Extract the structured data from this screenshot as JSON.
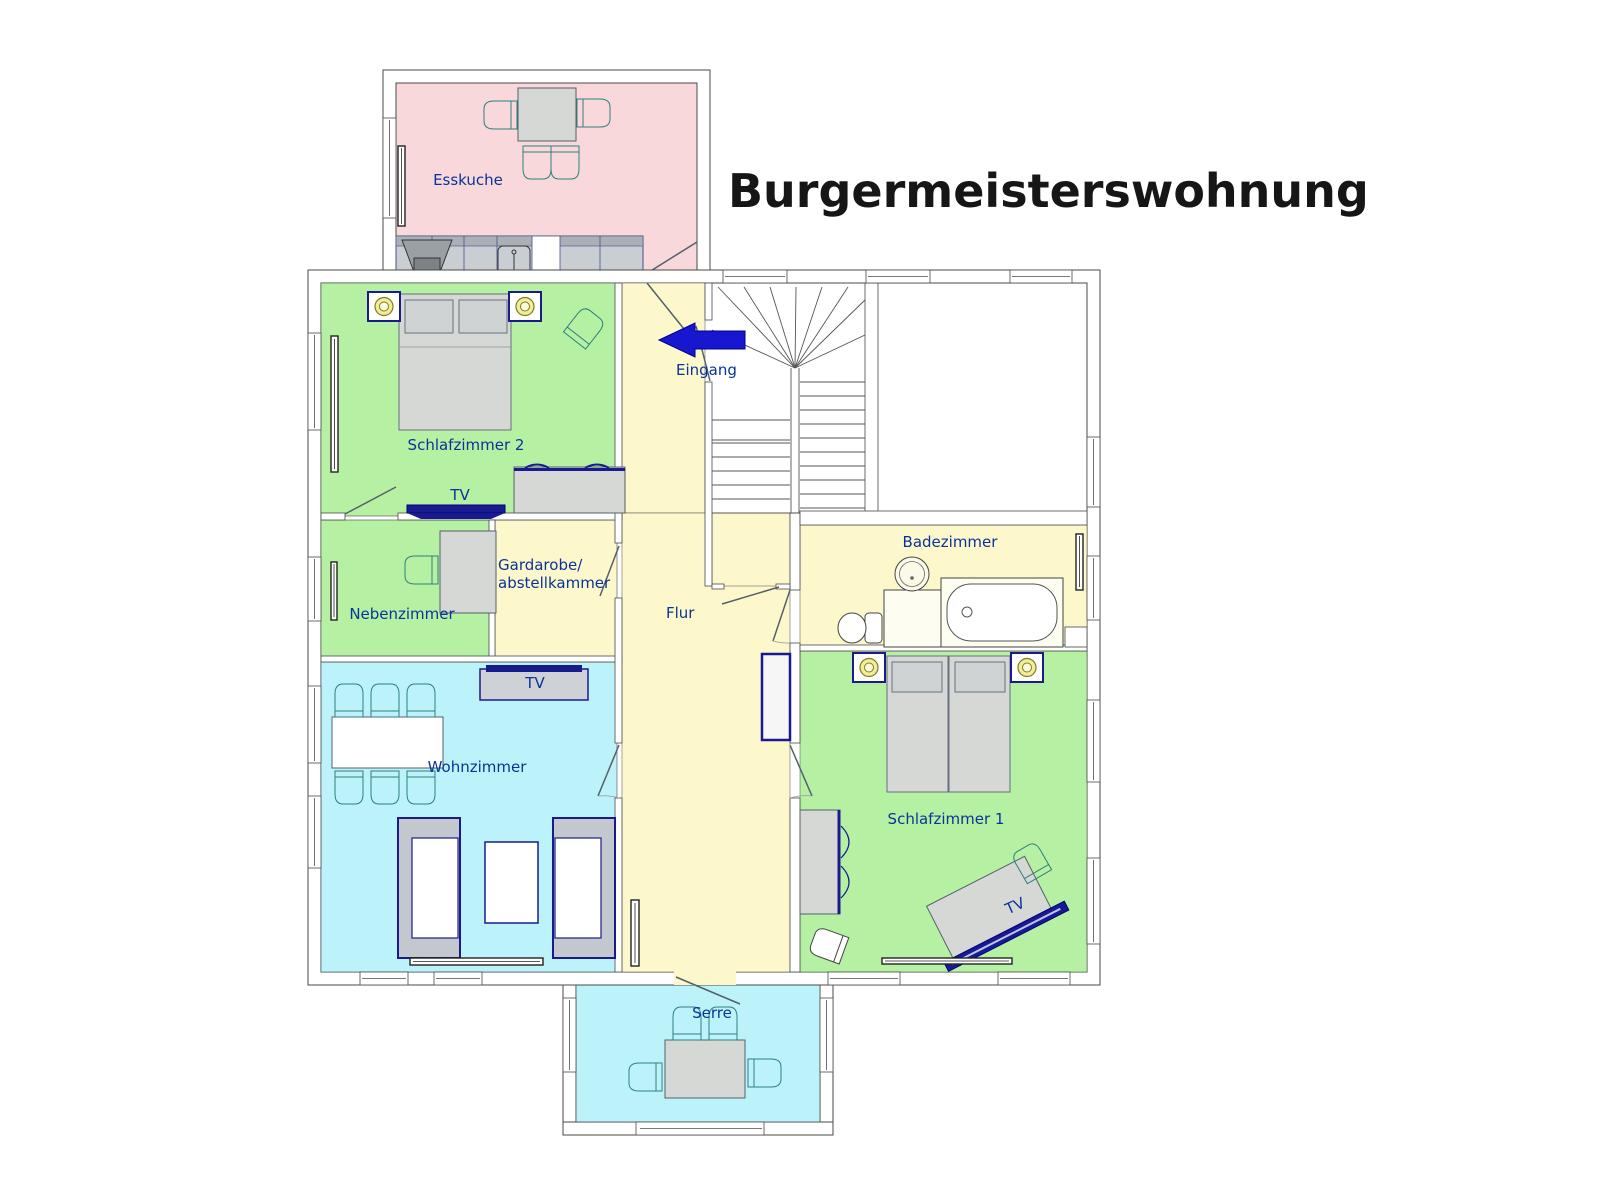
{
  "title": "Burgermeisterswohnung",
  "rooms": {
    "esskuche": {
      "label": "Esskuche",
      "color": "#f8d8db"
    },
    "schlafzimmer2": {
      "label": "Schlafzimmer 2",
      "color": "#b6f1a3"
    },
    "nebenzimmer": {
      "label": "Nebenzimmer",
      "color": "#b6f1a3"
    },
    "gardarobe": {
      "label_line1": "Gardarobe/",
      "label_line2": "abstellkammer",
      "color": "#fcf8cc"
    },
    "flur": {
      "label": "Flur",
      "color": "#fcf8cc"
    },
    "badezimmer": {
      "label": "Badezimmer",
      "color": "#fcf8cc"
    },
    "wohnzimmer": {
      "label": "Wohnzimmer",
      "color": "#bcf3fa"
    },
    "schlafzimmer1": {
      "label": "Schlafzimmer 1",
      "color": "#b6f1a3"
    },
    "serre": {
      "label": "Serre",
      "color": "#bcf3fa"
    }
  },
  "entrance": {
    "label": "Eingang",
    "arrow_color": "#1717d0"
  },
  "labels": {
    "tv": "TV"
  },
  "colors": {
    "wall_line": "#4a4a4a",
    "furniture_gray": "#d5d8d5",
    "accent_navy": "#1a1a8f",
    "chair_teal": "#2f7f7f",
    "label_text": "#0a3399",
    "title_text": "#161616",
    "lamp_yellow": "#f2ec9b"
  }
}
